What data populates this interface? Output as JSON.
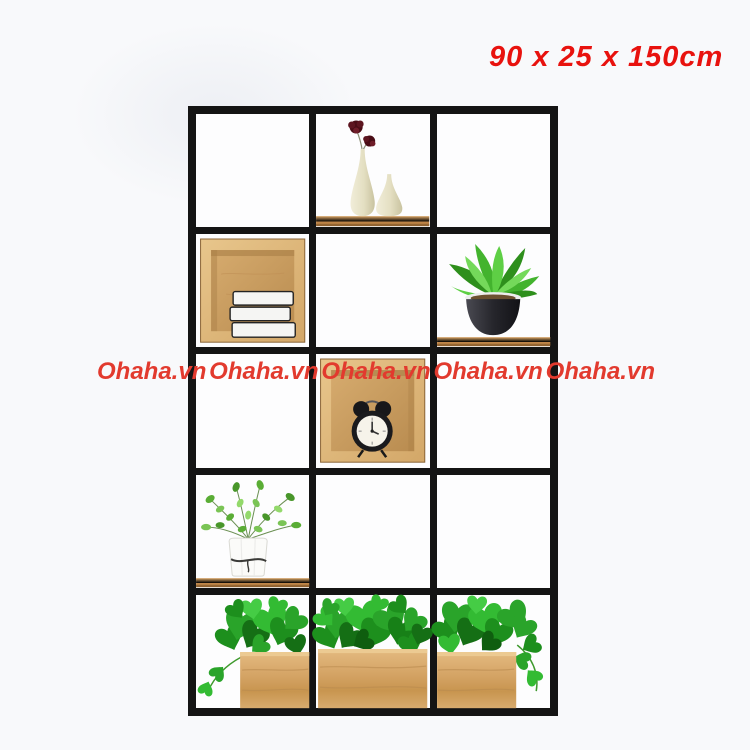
{
  "page": {
    "kind": "product-photo"
  },
  "theme": {
    "bg": "#f8f9fb",
    "label-red": "#e8120e",
    "watermark-red": "#e23a2e",
    "frame": "#141414",
    "cell-bg": "#fdfdfe",
    "wood": "#cf9f60"
  },
  "product_label": {
    "text": "90 x 25 x 150cm"
  },
  "watermarks": {
    "text": "Ohaha.vn",
    "count": 5
  },
  "shelf": {
    "rows": 5,
    "cols": 3,
    "items": [
      {
        "cell": "row1-col2",
        "name": "two-cream-vases-with-dark-red-flowers-on-wood-shelf"
      },
      {
        "cell": "row2-col1",
        "name": "wooden-cube-box-with-three-white-books"
      },
      {
        "cell": "row2-col3",
        "name": "green-plant-in-black-pot-on-wood-shelf"
      },
      {
        "cell": "row3-col2",
        "name": "wooden-cube-box-with-black-twin-bell-alarm-clock"
      },
      {
        "cell": "row4-col1",
        "name": "green-plant-in-white-pot-on-wood-shelf"
      },
      {
        "cell": "row5-col1",
        "name": "pothos-vine-in-wooden-planter"
      },
      {
        "cell": "row5-col2",
        "name": "pothos-vine-in-wooden-planter"
      },
      {
        "cell": "row5-col3",
        "name": "pothos-vine-in-wooden-planter"
      }
    ]
  }
}
